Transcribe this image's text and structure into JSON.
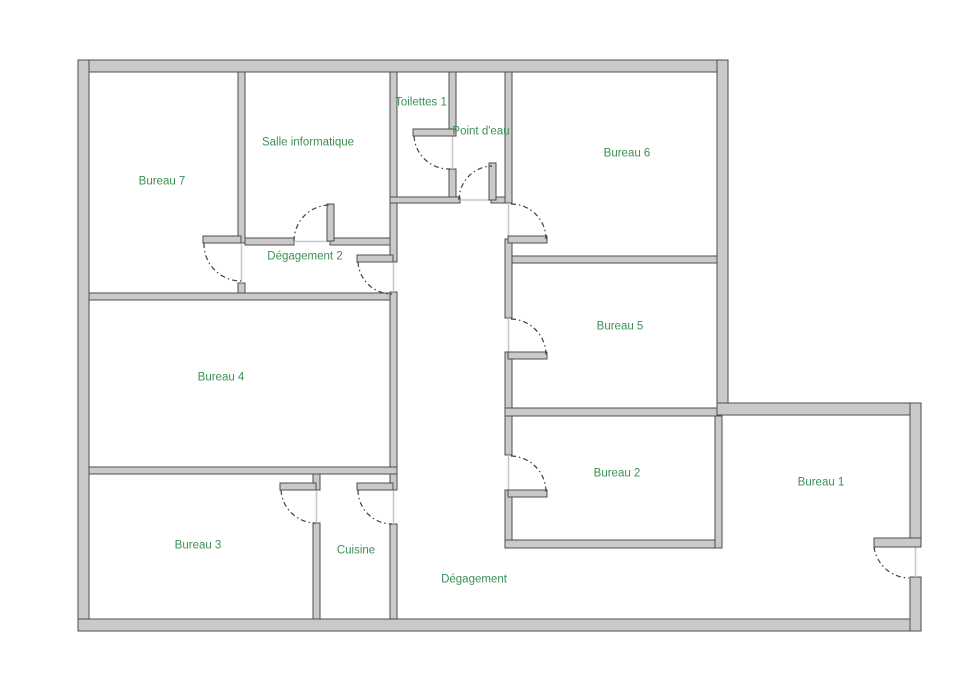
{
  "plan": {
    "type": "floor-plan",
    "language": "fr"
  },
  "colors": {
    "background": "#ffffff",
    "wall_fill": "#cacaca",
    "wall_stroke": "#4d4d4d",
    "label": "#3c9054",
    "door_arc": "#3f3f3f",
    "threshold": "#c6c6c6"
  },
  "rooms": [
    {
      "id": "bureau-7",
      "label": "Bureau 7"
    },
    {
      "id": "salle-informatique",
      "label": "Salle informatique"
    },
    {
      "id": "toilettes-1",
      "label": "Toilettes 1"
    },
    {
      "id": "point-deau",
      "label": "Point d'eau"
    },
    {
      "id": "bureau-6",
      "label": "Bureau 6"
    },
    {
      "id": "degagement-2",
      "label": "Dégagement 2"
    },
    {
      "id": "bureau-5",
      "label": "Bureau 5"
    },
    {
      "id": "bureau-4",
      "label": "Bureau 4"
    },
    {
      "id": "bureau-2",
      "label": "Bureau 2"
    },
    {
      "id": "bureau-1",
      "label": "Bureau 1"
    },
    {
      "id": "bureau-3",
      "label": "Bureau 3"
    },
    {
      "id": "cuisine",
      "label": "Cuisine"
    },
    {
      "id": "degagement",
      "label": "Dégagement"
    }
  ]
}
